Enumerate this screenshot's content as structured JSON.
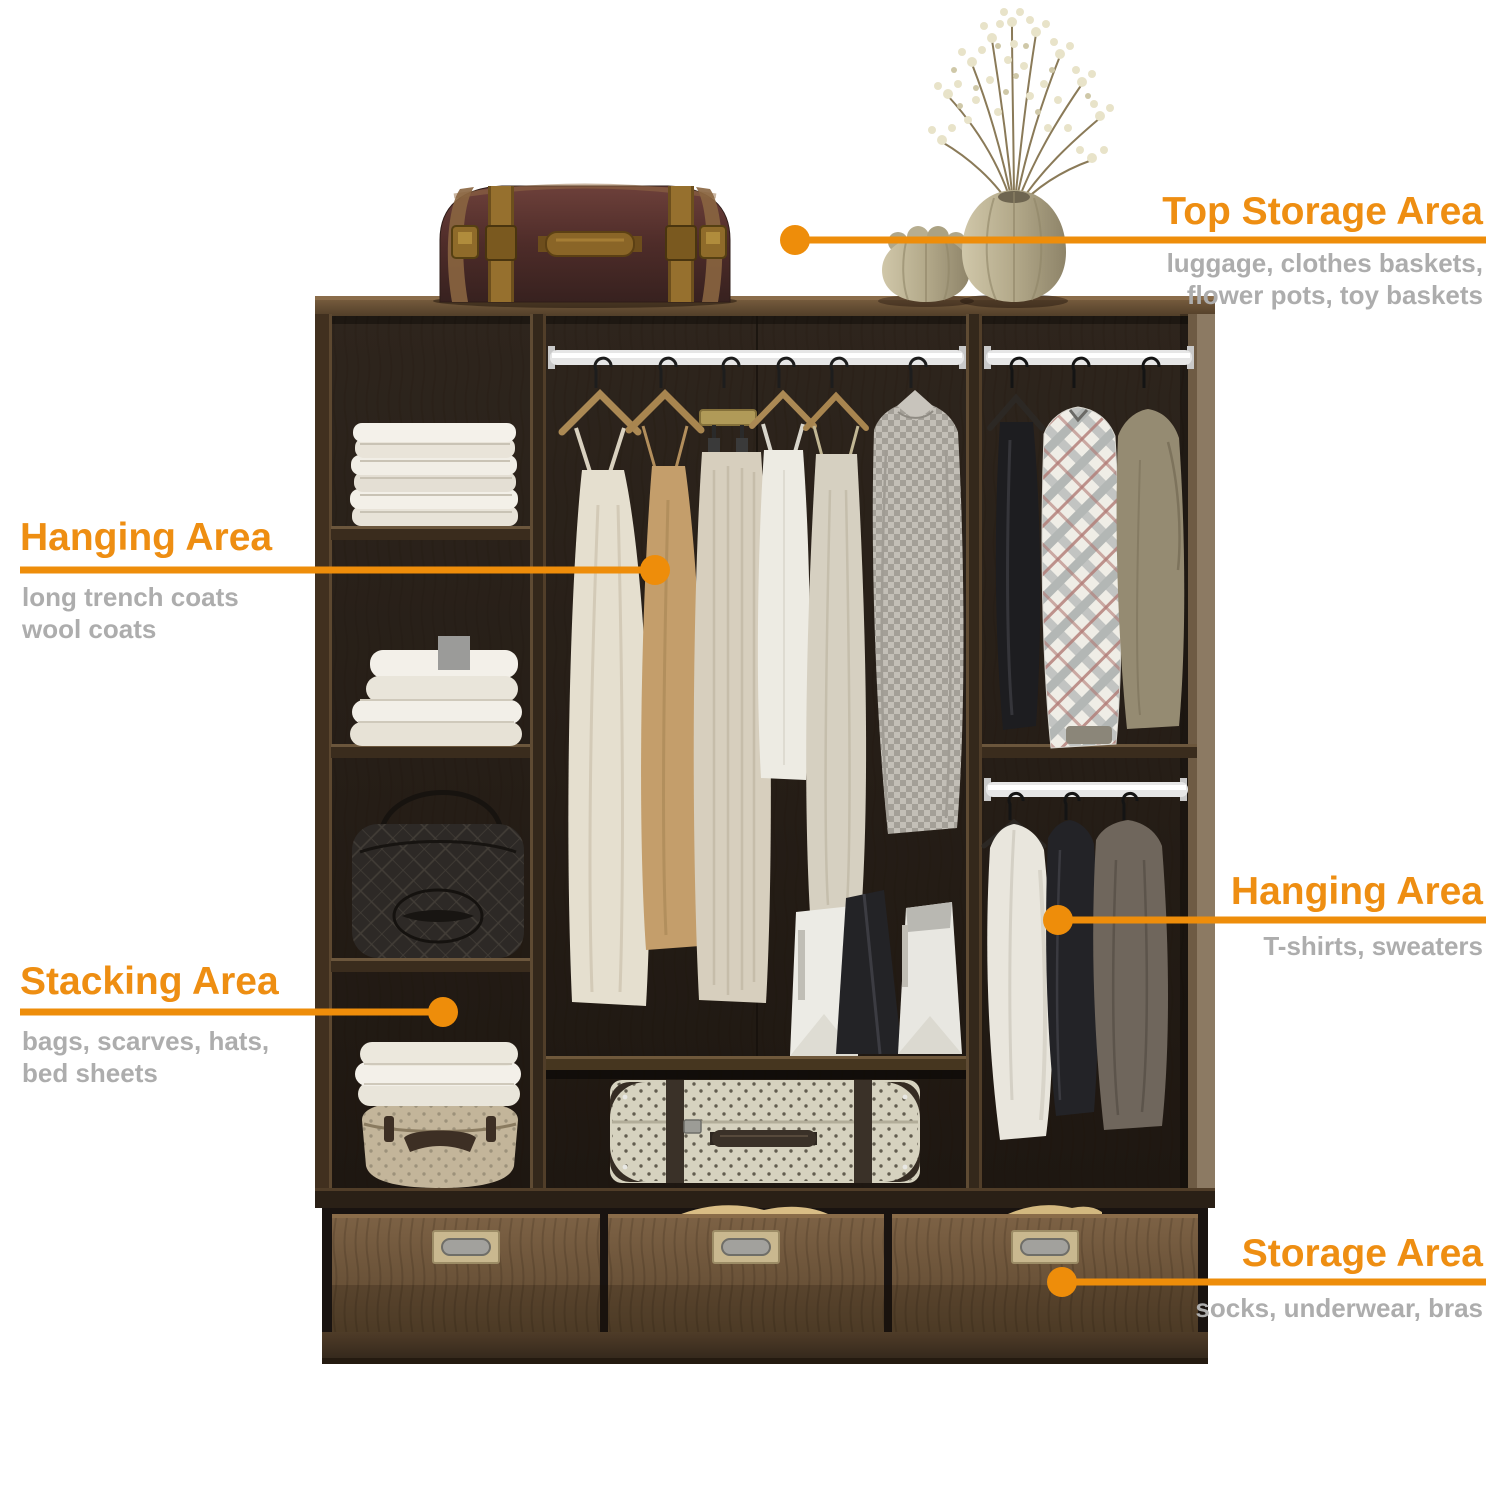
{
  "colors": {
    "accent_orange": "#EE8D0A",
    "title_orange": "#EE8E12",
    "subtitle_gray": "#ADADAD",
    "cabinet_wood": "#6B5339",
    "interior_dark": "#261E17"
  },
  "callouts": {
    "top_storage": {
      "title": "Top Storage Area",
      "lines": [
        "luggage, clothes baskets,",
        "flower pots, toy baskets"
      ]
    },
    "hanging_left": {
      "title": "Hanging Area",
      "lines": [
        "long trench coats",
        "wool coats"
      ]
    },
    "stacking": {
      "title": "Stacking Area",
      "lines": [
        "bags, scarves, hats,",
        "bed sheets"
      ]
    },
    "hanging_right": {
      "title": "Hanging Area",
      "lines": [
        "T-shirts, sweaters"
      ]
    },
    "storage": {
      "title": "Storage Area",
      "lines": [
        "socks, underwear, bras"
      ]
    }
  }
}
